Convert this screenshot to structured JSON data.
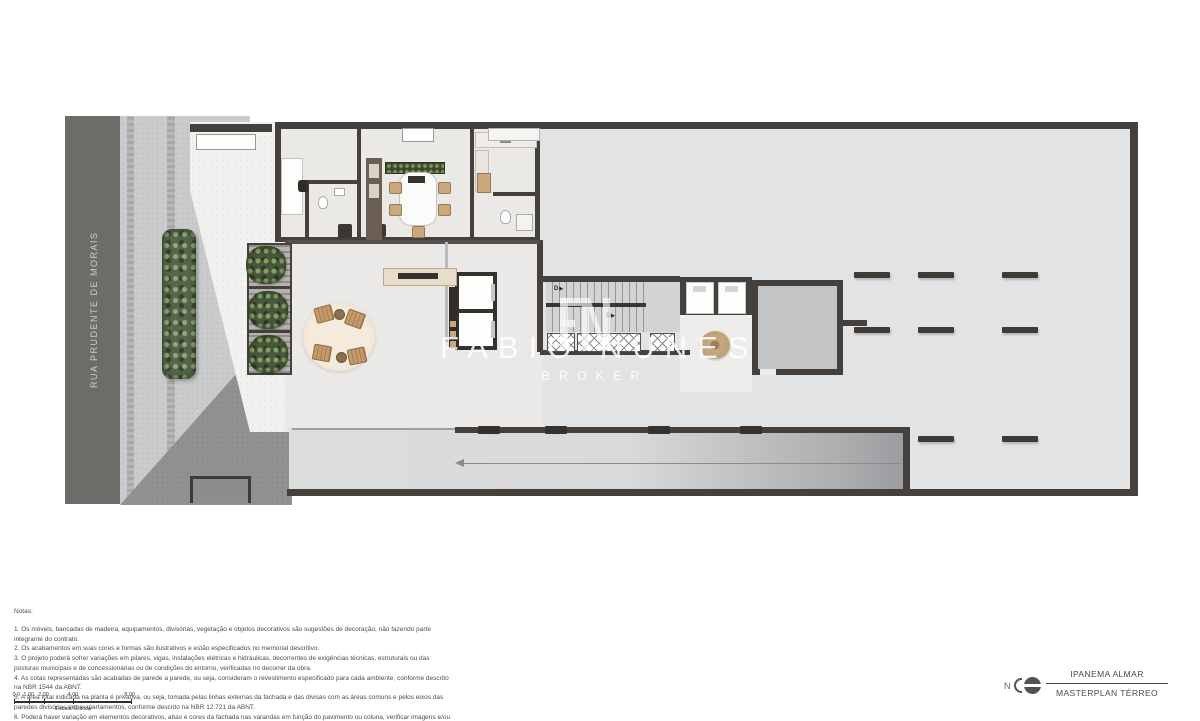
{
  "title_block": {
    "project": "IPANEMA ALMAR",
    "drawing": "MASTERPLAN TÉRREO"
  },
  "north": {
    "label": "N"
  },
  "street": {
    "name": "RUA PRUDENTE DE MORAIS"
  },
  "watermark": {
    "brand": "FABIO NUNES",
    "tagline": "BROKER"
  },
  "plan": {
    "stair_down_label": "D",
    "stair_up_label": "S",
    "stair_arrow": "▶"
  },
  "notes": {
    "heading": "Notas:",
    "items": [
      "1. Os móveis, bancadas de madeira, equipamentos, divisórias, vegetação e objetos decorativos são sugestões de decoração, não fazendo parte integrante do contrato.",
      "2. Os acabamentos em suas cores e formas são ilustrativos e estão especificados no memorial descritivo.",
      "3. O projeto poderá sofrer variações em pilares, vigas, instalações elétricas e hidráulicas, decorrentes de exigências técnicas, estruturais ou das posturas municipais e de concessionárias ou de condições do entorno, verificadas no decorrer da obra.",
      "4. As cotas representadas são acabadas de parede a parede, ou seja, consideram o revestimento especificado para cada ambiente, conforme descrito na NBR 1544 da ABNT.",
      "5. A área total indicada na planta é privativa, ou seja, tomada pelas linhas externas da fachada e das divisas com as áreas comuns e pelos eixos das paredes divisórias entre apartamentos, conforme descrito na NBR 12.721 da ABNT.",
      "6. Poderá haver variação em elementos decorativos, abas e cores da fachada nas varandas em função do pavimento ou coluna, verificar imagens e/ou maquete.",
      "7. A unidade será entregue com infraestrutura para instalação de ar condicionado tipo split ou multi-split, as evaporadoras e condensadoras poderão sofrer mudanças de posição ou quantidade, caso necessário. Os condensadores ficarão no terraços dos Up Gardens."
    ]
  },
  "scale_bar": {
    "ticks": [
      "0.0",
      "1.00",
      "2.00",
      "4.00",
      "8.00"
    ],
    "caption": "Escala Gráfica"
  },
  "colors": {
    "street": "#6e6c68",
    "sidewalk": "#c9cbcc",
    "wall": "#45403c",
    "slab": "#e2e3e4",
    "vegetation": "#55644a",
    "wood": "#c9a87e",
    "watermark": "rgba(255,255,255,0.85)"
  }
}
